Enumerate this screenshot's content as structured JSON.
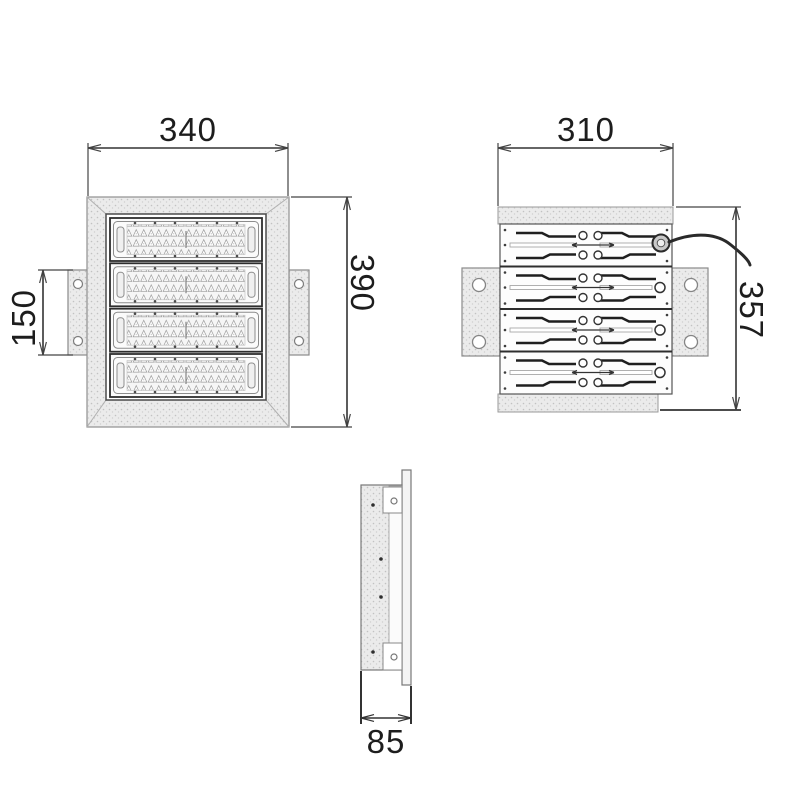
{
  "title": "recessed LED floodlight dimension drawing",
  "dimensions": {
    "front_width": "340",
    "front_height": "390",
    "bracket_height": "150",
    "back_width": "310",
    "back_height": "357",
    "side_depth": "85"
  },
  "colors": {
    "line": "#3c3c3c",
    "stroke_dark": "#2e2e2e",
    "fill_stipple": "#ebebeb",
    "background": "#ffffff"
  }
}
